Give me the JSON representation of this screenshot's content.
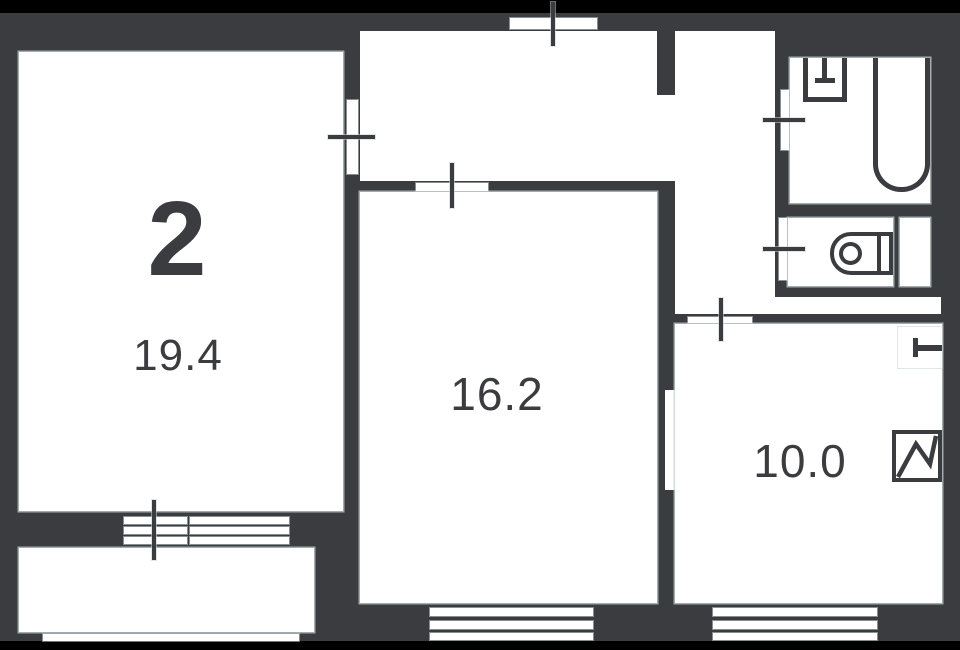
{
  "plan": {
    "type": "apartment-floor-plan",
    "unit_label": "2",
    "rooms": [
      {
        "id": "room-left",
        "area": "19.4"
      },
      {
        "id": "room-middle",
        "area": "16.2"
      },
      {
        "id": "room-right",
        "area": "10.0"
      }
    ],
    "spaces": [
      "hallway",
      "corridor",
      "bathroom",
      "wc",
      "shaft",
      "balcony"
    ],
    "fixtures": [
      "bathtub-icon",
      "washbasin-icon",
      "toilet-icon",
      "ventilation-shaft-icon",
      "radiator-icon",
      "window",
      "door-opening",
      "door-swing-tick",
      "balcony-railing"
    ],
    "colors": {
      "wall": "#3a3c3f",
      "floor": "#ffffff",
      "frame": "#000000",
      "edge_highlight": "#c6d1d1",
      "label": "#3a3c3f"
    }
  }
}
